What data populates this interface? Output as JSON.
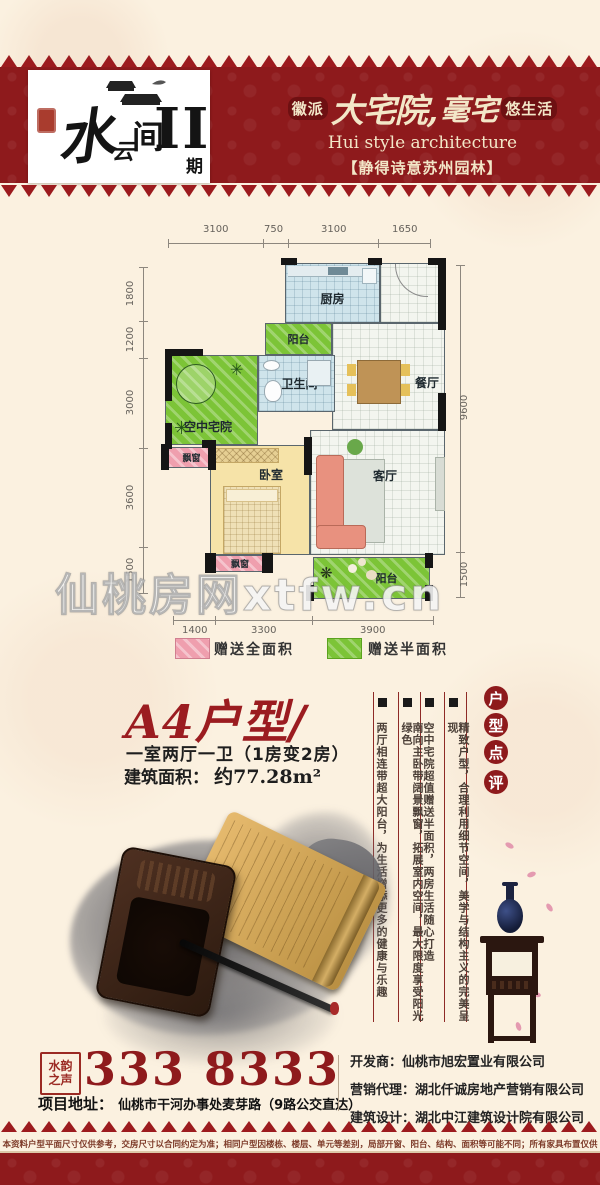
{
  "header": {
    "logo": {
      "name_chars": [
        "水",
        "云",
        "间"
      ],
      "phase": "II",
      "phase_suffix": "期"
    },
    "tagline": {
      "badge_left": "徽派",
      "script_a": "大宅院,",
      "script_b": "毫宅",
      "badge_right": "悠生活",
      "en": "Hui style architecture",
      "cn": "【静得诗意苏州园林】"
    }
  },
  "floorplan": {
    "dims_top": [
      "3100",
      "750",
      "3100",
      "1650"
    ],
    "dims_left": [
      "1800",
      "1200",
      "3000",
      "3600",
      "1500"
    ],
    "dims_right": [
      "9600",
      "1500"
    ],
    "dims_bottom": [
      "1400",
      "3300",
      "3900"
    ],
    "rooms": {
      "kitchen": "厨房",
      "balcony_mid": "阳台",
      "bathroom": "卫生间",
      "dining": "餐厅",
      "courtyard": "空中宅院",
      "bay_upper": "飘窗",
      "bedroom": "卧室",
      "living": "客厅",
      "bay_lower": "飘窗",
      "balcony_bottom": "阳台"
    },
    "watermark": "仙桃房网xtfw.cn",
    "legend": [
      {
        "label": "赠送全面积",
        "color": "#ef9fae"
      },
      {
        "label": "赠送半面积",
        "color": "#7cc437"
      }
    ]
  },
  "unit": {
    "title": "A4户型/",
    "layout": "一室两厅一卫（1房变2房）",
    "area_label": "建筑面积：",
    "area_value": "约77.28m²"
  },
  "review": {
    "title_chars": [
      "户",
      "型",
      "点",
      "评"
    ],
    "points": [
      "精致户型，合理利用细节空间，美学与结构主义的完美呈现",
      "空中宅院超值赠送半面积，两房生活随心打造",
      "南向主卧带阔景飘窗，拓展室内空间，最大限度享受阳光绿色",
      "两厅相连带超大阳台，为生活增添更多的健康与乐趣"
    ]
  },
  "contact": {
    "seal_line1": "水韵",
    "seal_line2": "之声",
    "phone": "333 8333",
    "address_label": "项目地址：",
    "address": "仙桃市干河办事处麦芽路（9路公交直达）",
    "companies": [
      {
        "label": "开发商：",
        "name": "仙桃市旭宏置业有限公司"
      },
      {
        "label": "营销代理：",
        "name": "湖北仟诚房地产营销有限公司"
      },
      {
        "label": "建筑设计：",
        "name": "湖北中江建筑设计院有限公司"
      }
    ]
  },
  "footer": {
    "disclaimer": "本资料户型平面尺寸仅供参考，交房尺寸以合同约定为准；相同户型因楼栋、楼层、单元等差别，局部开窗、阳台、结构、面积等可能不同；所有家具布置仅供参考；解释权归开发商所有。"
  },
  "colors": {
    "brand_red": "#8e1a1c",
    "accent_red": "#9b1c20",
    "cream": "#fbf1e0"
  }
}
